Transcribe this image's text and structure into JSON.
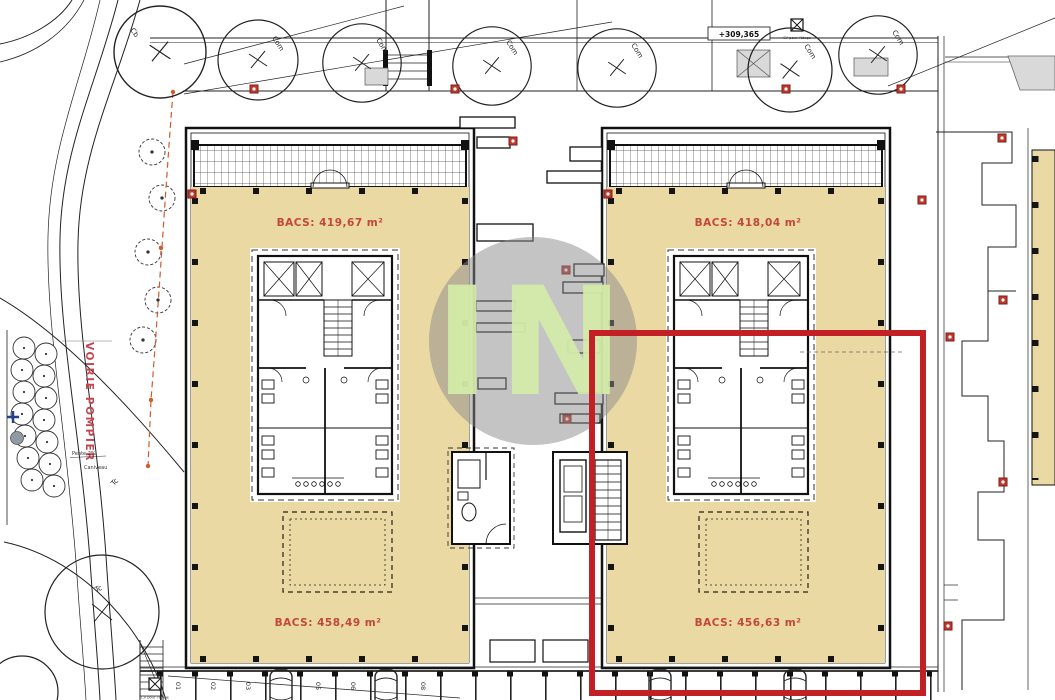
{
  "watermark": {
    "text": "IN"
  },
  "site": {
    "street_label": "VOIRIE POMPIER",
    "slope_label": "Pente 2%",
    "gutter_label": "Caniveau",
    "elevation_label": "+309,365",
    "cv_box_label": "CV pour l'étage",
    "tree_labels": {
      "com": "Com",
      "tc": "Tc",
      "cb": "Cb"
    }
  },
  "buildings": [
    {
      "id": "building-left",
      "bacs_top": "BACS: 419,67 m²",
      "bacs_bottom": "BACS: 458,49 m²"
    },
    {
      "id": "building-right",
      "bacs_top": "BACS: 418,04 m²",
      "bacs_bottom": "BACS: 456,63 m²"
    }
  ],
  "parking": {
    "numbers": [
      "01",
      "02",
      "03",
      "05",
      "06",
      "08"
    ]
  },
  "colors": {
    "floor_beige": "#EBD9A3",
    "highlight_red": "#C32026",
    "bacs_label_red": "#C2473C",
    "street_label_red": "#C14853",
    "survey_marker_red": "#C0392B",
    "watermark_circle_gray": "#8A8A8A",
    "watermark_text_green": "#D5EDA9",
    "landscape_dash_orange": "#CF5B2E",
    "survey_cross_blue": "#23408E",
    "gray_fill": "#D9D9D9"
  }
}
